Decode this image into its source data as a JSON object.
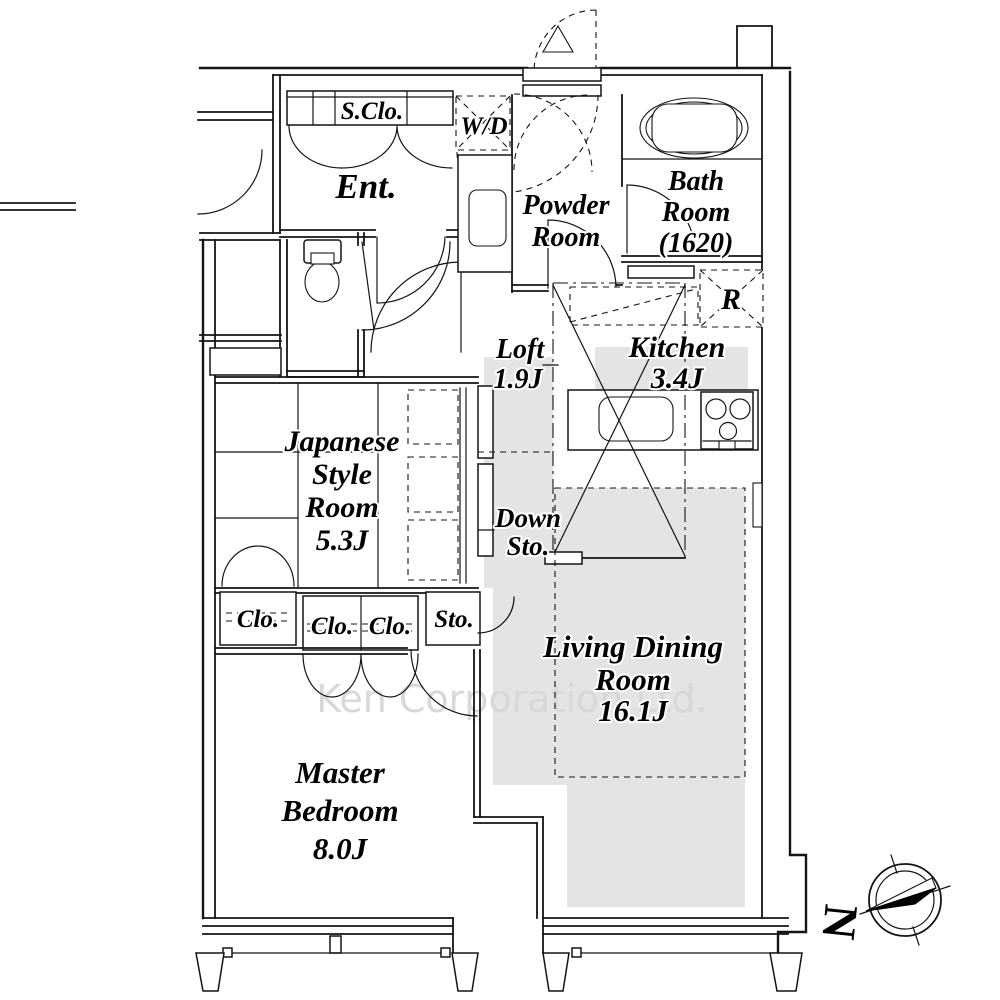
{
  "floorplan": {
    "rooms": {
      "entrance": {
        "label": "Ent."
      },
      "shoe_closet": {
        "label": "S.Clo."
      },
      "washer_dryer": {
        "label": "W/D"
      },
      "powder": {
        "line1": "Powder",
        "line2": "Room"
      },
      "bath": {
        "line1": "Bath",
        "line2": "Room",
        "line3": "(1620)"
      },
      "refrigerator": {
        "label": "R"
      },
      "kitchen": {
        "line1": "Kitchen",
        "line2": "3.4J"
      },
      "loft": {
        "line1": "Loft",
        "line2": "1.9J"
      },
      "japanese": {
        "line1": "Japanese",
        "line2": "Style",
        "line3": "Room",
        "line4": "5.3J"
      },
      "down_storage": {
        "line1": "Down",
        "line2": "Sto."
      },
      "living_dining": {
        "line1": "Living Dining",
        "line2": "Room",
        "line3": "16.1J"
      },
      "closet_left": {
        "label": "Clo."
      },
      "closet_mid_a": {
        "label": "Clo."
      },
      "closet_mid_b": {
        "label": "Clo."
      },
      "storage": {
        "label": "Sto."
      },
      "master": {
        "line1": "Master",
        "line2": "Bedroom",
        "line3": "8.0J"
      }
    },
    "compass": {
      "north_label": "N"
    },
    "watermark": "Ken Corporation Ltd.",
    "colors": {
      "line": "#141414",
      "shade": "#e4e4e4",
      "watermark": "#d8d8d8"
    }
  }
}
